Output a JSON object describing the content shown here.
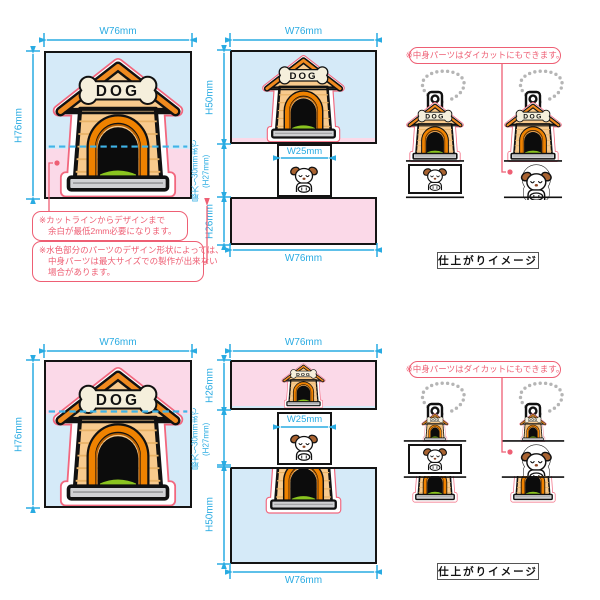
{
  "colors": {
    "dimension_cyan": "#29abe2",
    "dashed_split_cyan": "#3fb4e8",
    "annotation_red": "#ee5f74",
    "cutline_red": "#f2677e",
    "lightblue_zone": "#d5eaf8",
    "pink_zone": "#fbd9e8",
    "roof_orange": "#f08a1f",
    "wall_tan": "#f8ca8d",
    "grass_green": "#8ac41f",
    "bone_cream": "#f5efdc",
    "base_gray": "#d0d1d3"
  },
  "labels": {
    "w76": "W76mm",
    "h76": "H76mm",
    "h50": "H50mm",
    "h26": "H26mm",
    "w25": "W25mm",
    "max30": "最大〜30mmまで",
    "h27": "(H27mm)",
    "dog_sign": "DOG",
    "finished": "仕上がりイメージ"
  },
  "notes": {
    "cutline_1": "※カットラインからデザインまで",
    "cutline_2": "余白が最低2mm必要になります。",
    "lightblue_1": "※水色部分のパーツのデザイン形状によっては、",
    "lightblue_2": "中身パーツは最大サイズでの製作が出来ない",
    "lightblue_3": "場合があります。",
    "diecut": "※中身パーツはダイカットにもできます。"
  }
}
